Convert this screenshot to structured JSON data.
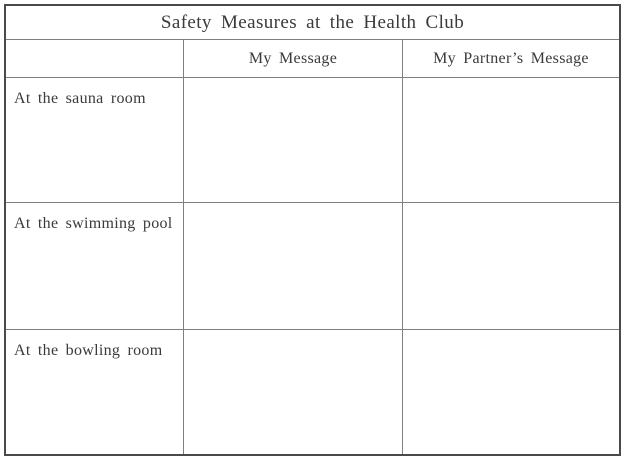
{
  "table": {
    "title": "Safety Measures at the Health Club",
    "header": {
      "row_label_column": "",
      "my_message": "My Message",
      "partner_message": "My Partner’s Message"
    },
    "rows": [
      {
        "label": "At the sauna room",
        "my_message": "",
        "partner_message": ""
      },
      {
        "label": "At the swimming pool",
        "my_message": "",
        "partner_message": ""
      },
      {
        "label": "At the bowling room",
        "my_message": "",
        "partner_message": ""
      }
    ],
    "colors": {
      "outer_border": "#4a4a4a",
      "inner_border": "#7f7f7f",
      "text": "#3a3a3a",
      "background": "#ffffff"
    }
  }
}
